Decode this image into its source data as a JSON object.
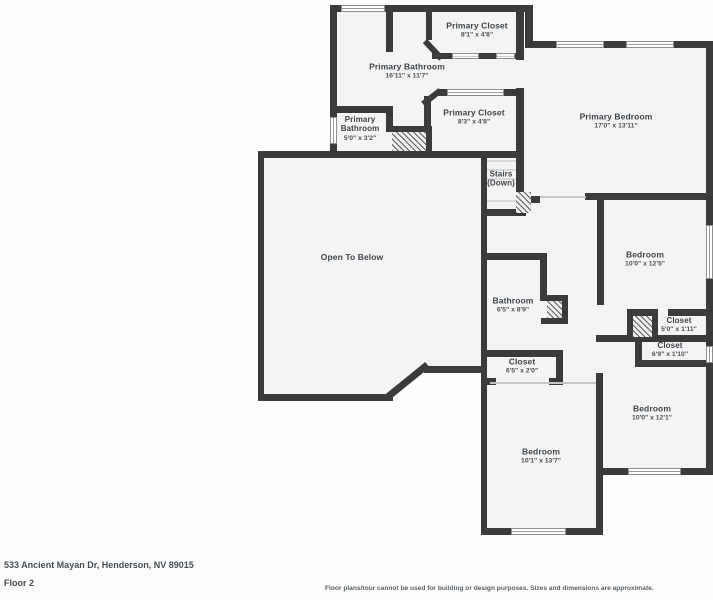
{
  "plan": {
    "rooms": [
      {
        "name": "Primary Closet",
        "dims": "8'1\" x 4'8\""
      },
      {
        "name": "Primary Bathroom",
        "dims": "16'11\" x 11'7\""
      },
      {
        "name": "Primary Bathroom",
        "dims": "5'0\" x 3'2\""
      },
      {
        "name": "Primary Closet",
        "dims": "8'3\" x 4'8\""
      },
      {
        "name": "Primary Bedroom",
        "dims": "17'0\" x 13'11\""
      },
      {
        "name": "Stairs",
        "dims": "(Down)"
      },
      {
        "name": "Open To Below",
        "dims": ""
      },
      {
        "name": "Bedroom",
        "dims": "10'0\" x 12'5\""
      },
      {
        "name": "Bathroom",
        "dims": "6'5\" x 8'9\""
      },
      {
        "name": "Closet",
        "dims": "5'0\" x 1'11\""
      },
      {
        "name": "Closet",
        "dims": "6'9\" x 1'10\""
      },
      {
        "name": "Closet",
        "dims": "6'5\" x 2'0\""
      },
      {
        "name": "Bedroom",
        "dims": "10'0\" x 12'1\""
      },
      {
        "name": "Bedroom",
        "dims": "10'1\" x 13'7\""
      }
    ],
    "colors": {
      "wall": "#3b3b3b",
      "room_fill": "#f4f4f4",
      "background": "#fdfdfd"
    }
  },
  "footer": {
    "address": "533 Ancient Mayan Dr, Henderson, NV 89015",
    "floor": "Floor 2",
    "disclaimer": "Floor plans/tour cannot be used for building or design purposes. Sizes and dimensions are approximate."
  }
}
